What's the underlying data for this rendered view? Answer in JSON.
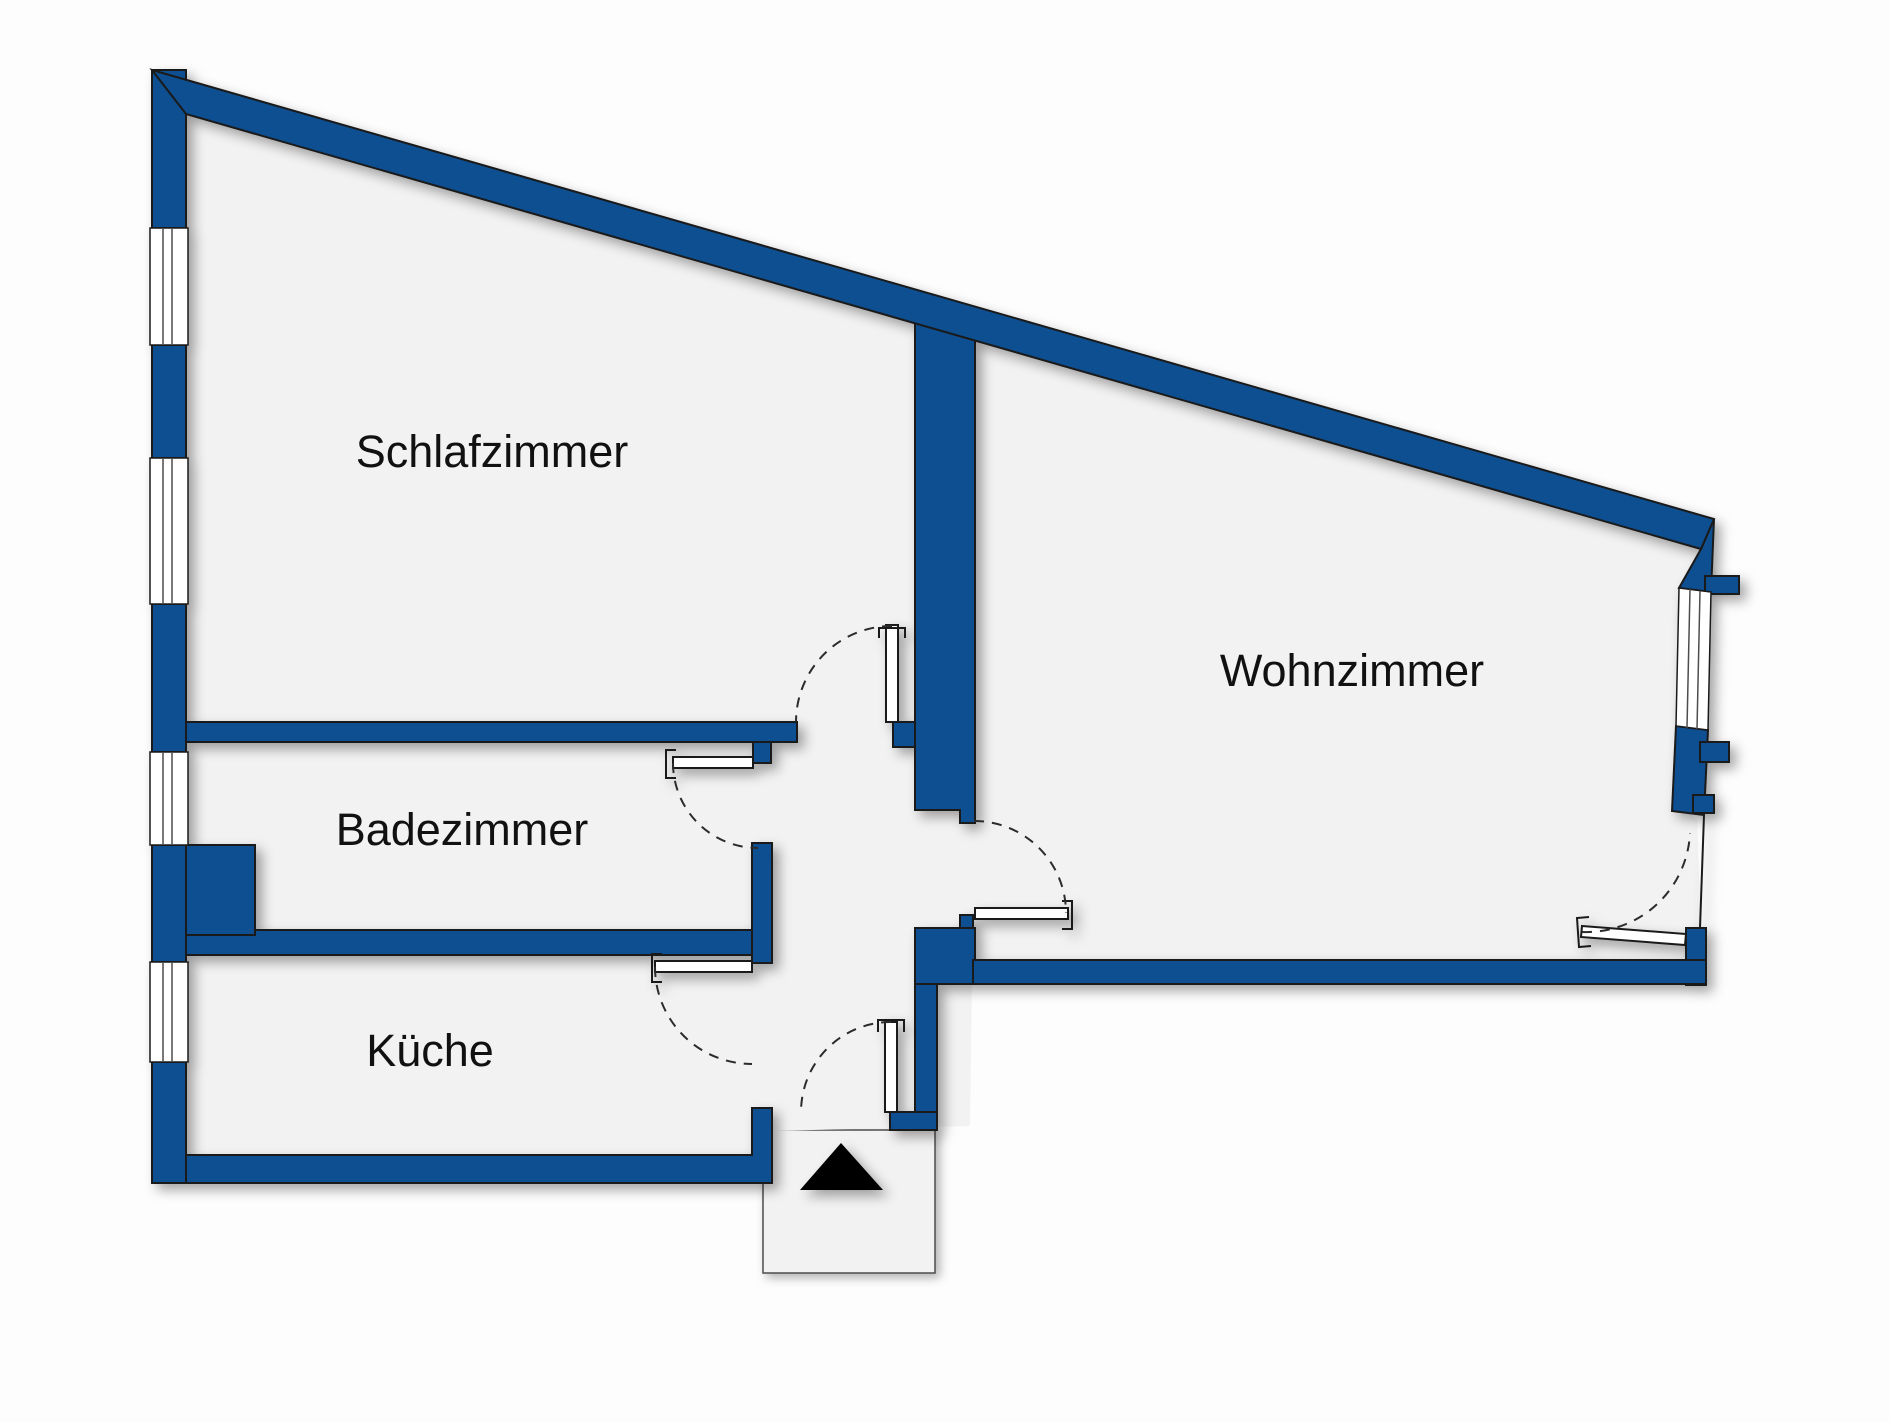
{
  "floor_plan": {
    "rooms": [
      {
        "id": "schlafzimmer",
        "label": "Schlafzimmer"
      },
      {
        "id": "badezimmer",
        "label": "Badezimmer"
      },
      {
        "id": "kueche",
        "label": "Küche"
      },
      {
        "id": "wohnzimmer",
        "label": "Wohnzimmer"
      }
    ],
    "entrance_marker": "up-arrow-triangle",
    "features": {
      "left_wall_windows": 4,
      "right_wall_windows": 1,
      "doors": 6
    }
  },
  "colors": {
    "wall": "#0d4f91",
    "outline": "#1a1a1a",
    "floor": "#f2f2f2",
    "window_white": "#ffffff",
    "glass_line": "#4d4d4d",
    "arc": "#2b2b2b",
    "vestibule": "#f2f2f2",
    "vestibule_border": "#4d4d4d",
    "arrow": "#000000",
    "label": "#111111",
    "background": "#fdfdfd"
  }
}
